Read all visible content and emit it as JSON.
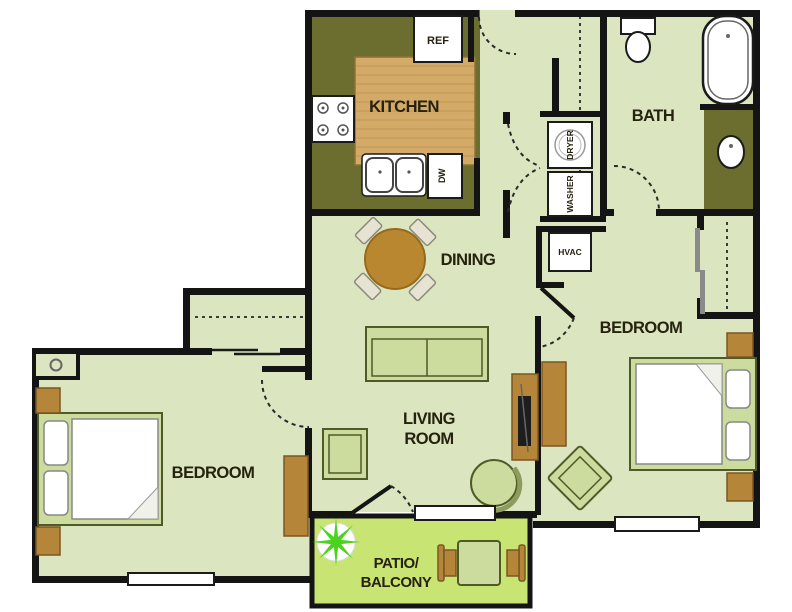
{
  "floorplan": {
    "rooms": {
      "kitchen": "KITCHEN",
      "bath": "BATH",
      "dining": "DINING",
      "living_room": [
        "LIVING",
        "ROOM"
      ],
      "bedroom_left": "BEDROOM",
      "bedroom_right": "BEDROOM",
      "patio": [
        "PATIO/",
        "BALCONY"
      ]
    },
    "labels": {
      "refrigerator": "REF",
      "dishwasher": "DW",
      "dryer": "DRYER",
      "washer": "WASHER",
      "hvac": "HVAC"
    },
    "colors": {
      "floor": "#dbe6c0",
      "kitchen_floor": "#6b6e2f",
      "island_wood": "#d4aa68",
      "dining_table": "#b9872f",
      "case_goods": "#b5853a",
      "upholstery": "#ccdc9e",
      "patio_floor": "#c8e472",
      "plant": "#4bd31d",
      "walls": "#141414"
    }
  }
}
